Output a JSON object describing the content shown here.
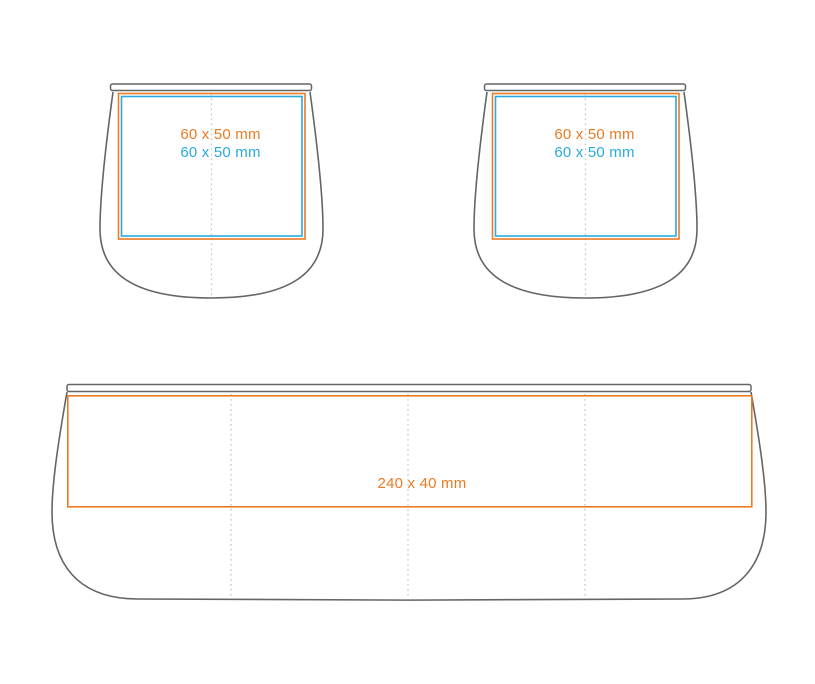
{
  "palette": {
    "outline": "#646567",
    "guide": "#c7c7c7",
    "orange": "#EC7A23",
    "blue": "#29A9E0"
  },
  "figures": {
    "cup_front": {
      "orange_label": "60 x 50 mm",
      "blue_label": "60 x 50 mm"
    },
    "cup_back": {
      "orange_label": "60 x 50 mm",
      "blue_label": "60 x 50 mm"
    },
    "wrap": {
      "orange_label": "240 x 40 mm"
    }
  }
}
